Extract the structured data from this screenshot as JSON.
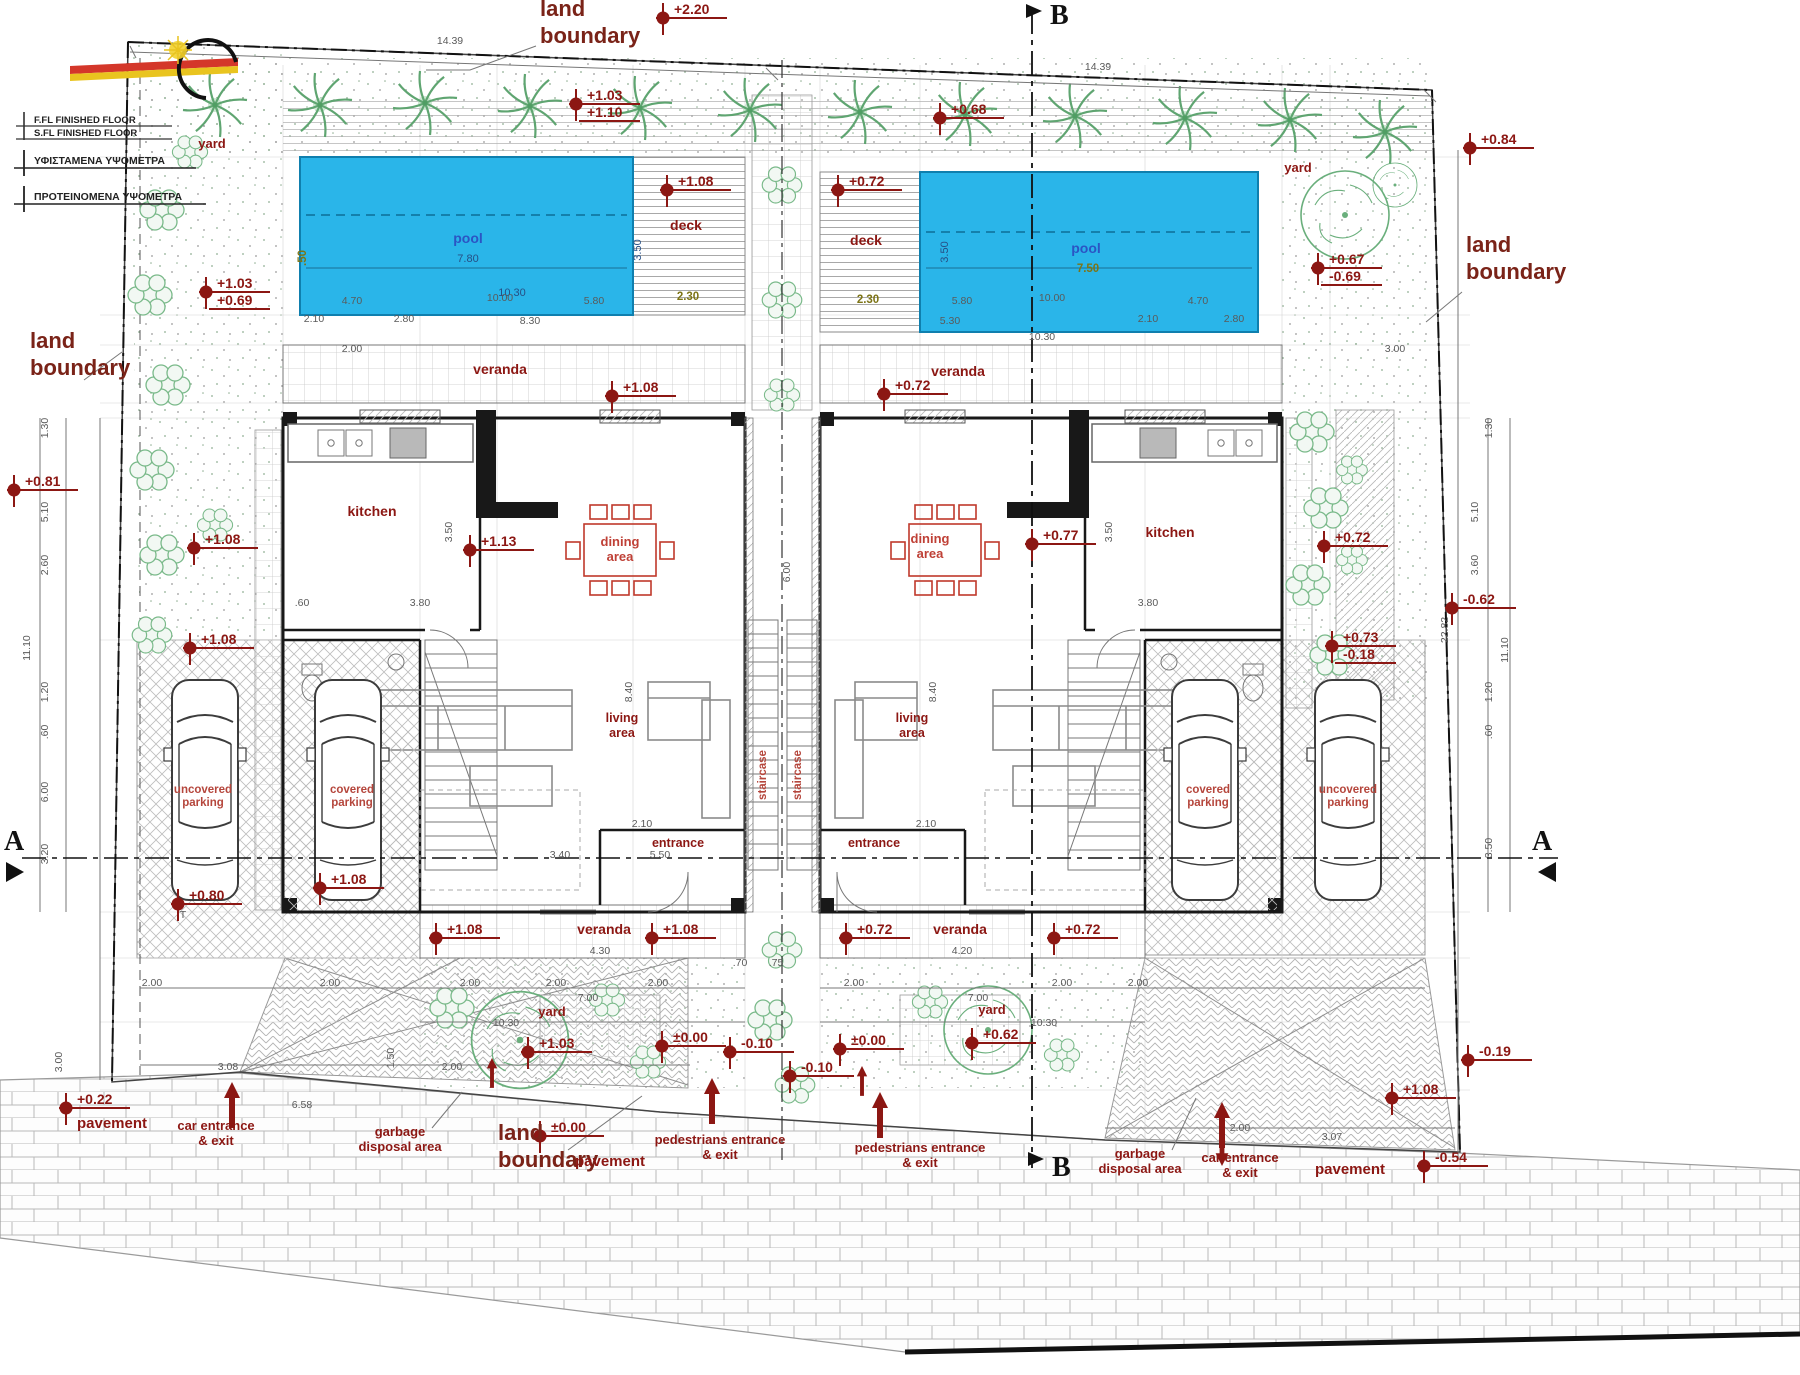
{
  "drawing": {
    "type": "architectural site plan, twin villas with pools",
    "colors": {
      "pool": "#2ab5e9",
      "pool_border": "#0f7fae",
      "label_dark_red": "#8c1713",
      "furniture_red": "#c0392b",
      "tree_green": "#5fa571",
      "wall_black": "#181818"
    }
  },
  "legend": {
    "row1a": "F.FL FINISHED FLOOR",
    "row1b": "S.FL FINISHED FLOOR",
    "row2": "ΥΦΙΣΤΑΜΕΝΑ ΥΨΟΜΕΤΡΑ",
    "row3": "ΠΡΟΤΕΙΝΟΜΕΝΑ ΥΨΟΜΕΤΡΑ"
  },
  "sections": {
    "a": "A",
    "b": "B"
  },
  "labels": [
    {
      "n": "label-yard-top-left",
      "t": "yard",
      "x": 212,
      "y": 148,
      "c": "lab-place-sm"
    },
    {
      "n": "label-yard-top-right",
      "t": "yard",
      "x": 1298,
      "y": 172,
      "c": "lab-place-sm"
    },
    {
      "n": "label-yard-bottom-left",
      "t": "yard",
      "x": 552,
      "y": 1016,
      "c": "lab-place-sm"
    },
    {
      "n": "label-yard-bottom-right",
      "t": "yard",
      "x": 992,
      "y": 1014,
      "c": "lab-place-sm"
    },
    {
      "n": "label-pool-left",
      "t": "pool",
      "x": 468,
      "y": 243,
      "c": "lab-pool"
    },
    {
      "n": "label-pool-right",
      "t": "pool",
      "x": 1086,
      "y": 253,
      "c": "lab-pool"
    },
    {
      "n": "label-deck-left",
      "t": "deck",
      "x": 686,
      "y": 230,
      "c": "lab-room"
    },
    {
      "n": "label-deck-right",
      "t": "deck",
      "x": 866,
      "y": 245,
      "c": "lab-room"
    },
    {
      "n": "label-veranda-top-left",
      "t": "veranda",
      "x": 500,
      "y": 374,
      "c": "lab-room"
    },
    {
      "n": "label-veranda-top-right",
      "t": "veranda",
      "x": 958,
      "y": 376,
      "c": "lab-room"
    },
    {
      "n": "label-kitchen-left",
      "t": "kitchen",
      "x": 372,
      "y": 516,
      "c": "lab-room"
    },
    {
      "n": "label-kitchen-right",
      "t": "kitchen",
      "x": 1170,
      "y": 537,
      "c": "lab-room"
    },
    {
      "n": "label-dining-left",
      "ls": [
        "dining",
        "area"
      ],
      "x": 620,
      "y": 546,
      "c": "lab-red",
      "lh": 15
    },
    {
      "n": "label-dining-right",
      "ls": [
        "dining",
        "area"
      ],
      "x": 930,
      "y": 543,
      "c": "lab-red",
      "lh": 15
    },
    {
      "n": "label-living-left",
      "ls": [
        "living",
        "area"
      ],
      "x": 622,
      "y": 722,
      "c": "lab-room-sm",
      "lh": 15
    },
    {
      "n": "label-living-right",
      "ls": [
        "living",
        "area"
      ],
      "x": 912,
      "y": 722,
      "c": "lab-room-sm",
      "lh": 15
    },
    {
      "n": "label-entrance-left",
      "t": "entrance",
      "x": 678,
      "y": 847,
      "c": "lab-room-sm"
    },
    {
      "n": "label-entrance-right",
      "t": "entrance",
      "x": 874,
      "y": 847,
      "c": "lab-room-sm"
    },
    {
      "n": "label-staircase-left",
      "t": "staircase",
      "x": 766,
      "y": 775,
      "c": "lab-red-sm",
      "r": -90
    },
    {
      "n": "label-staircase-right",
      "t": "staircase",
      "x": 801,
      "y": 775,
      "c": "lab-red-sm",
      "r": -90
    },
    {
      "n": "label-covered-parking-left",
      "ls": [
        "covered",
        "parking"
      ],
      "x": 352,
      "y": 793,
      "c": "lab-red-sm",
      "lh": 13
    },
    {
      "n": "label-uncovered-parking-left",
      "ls": [
        "uncovered",
        "parking"
      ],
      "x": 203,
      "y": 793,
      "c": "lab-red-sm",
      "lh": 13
    },
    {
      "n": "label-covered-parking-right",
      "ls": [
        "covered",
        "parking"
      ],
      "x": 1208,
      "y": 793,
      "c": "lab-red-sm",
      "lh": 13
    },
    {
      "n": "label-uncovered-parking-right",
      "ls": [
        "uncovered",
        "parking"
      ],
      "x": 1348,
      "y": 793,
      "c": "lab-red-sm",
      "lh": 13
    },
    {
      "n": "label-veranda-bottom-left",
      "t": "veranda",
      "x": 604,
      "y": 934,
      "c": "lab-room"
    },
    {
      "n": "label-veranda-bottom-right",
      "t": "veranda",
      "x": 960,
      "y": 934,
      "c": "lab-room"
    },
    {
      "n": "label-land-boundary-top",
      "ls": [
        "land",
        "boundary"
      ],
      "x": 540,
      "y": 16,
      "c": "lab-boundary",
      "a": "start",
      "lh": 27
    },
    {
      "n": "label-land-boundary-left",
      "ls": [
        "land",
        "boundary"
      ],
      "x": 30,
      "y": 348,
      "c": "lab-boundary",
      "a": "start",
      "lh": 27
    },
    {
      "n": "label-land-boundary-right",
      "ls": [
        "land",
        "boundary"
      ],
      "x": 1466,
      "y": 252,
      "c": "lab-boundary",
      "a": "start",
      "lh": 27
    },
    {
      "n": "label-land-boundary-bottom",
      "ls": [
        "land",
        "boundary"
      ],
      "x": 498,
      "y": 1140,
      "c": "lab-boundary",
      "a": "start",
      "lh": 27
    },
    {
      "n": "label-pavement-bottom-left",
      "t": "pavement",
      "x": 112,
      "y": 1128,
      "c": "lab-place"
    },
    {
      "n": "label-car-entrance-bottom-left",
      "ls": [
        "car entrance",
        "& exit"
      ],
      "x": 216,
      "y": 1130,
      "c": "lab-place-sm",
      "lh": 15
    },
    {
      "n": "label-garbage-bottom-left",
      "ls": [
        "garbage",
        "disposal area"
      ],
      "x": 400,
      "y": 1136,
      "c": "lab-place-sm",
      "lh": 15
    },
    {
      "n": "label-pavement-bottom-center",
      "t": "pavement",
      "x": 610,
      "y": 1166,
      "c": "lab-place"
    },
    {
      "n": "label-pedestrians-left",
      "ls": [
        "pedestrians entrance",
        "& exit"
      ],
      "x": 720,
      "y": 1144,
      "c": "lab-place-sm",
      "lh": 15
    },
    {
      "n": "label-pedestrians-right",
      "ls": [
        "pedestrians entrance",
        "& exit"
      ],
      "x": 920,
      "y": 1152,
      "c": "lab-place-sm",
      "lh": 15
    },
    {
      "n": "label-garbage-bottom-right",
      "ls": [
        "garbage",
        "disposal area"
      ],
      "x": 1140,
      "y": 1158,
      "c": "lab-place-sm",
      "lh": 15
    },
    {
      "n": "label-car-entrance-bottom-right",
      "ls": [
        "car entrance",
        "& exit"
      ],
      "x": 1240,
      "y": 1162,
      "c": "lab-place-sm",
      "lh": 15
    },
    {
      "n": "label-pavement-bottom-right",
      "t": "pavement",
      "x": 1350,
      "y": 1174,
      "c": "lab-place"
    },
    {
      "n": "label-t-mark",
      "t": "T",
      "x": 183,
      "y": 918,
      "c": "dim"
    }
  ],
  "elevation_markers": [
    {
      "v": "+2.20",
      "x": 663,
      "y": 18
    },
    {
      "v": "+1.03",
      "v2": "+1.10",
      "x": 576,
      "y": 104
    },
    {
      "v": "+0.68",
      "x": 940,
      "y": 118
    },
    {
      "v": "+1.08",
      "x": 667,
      "y": 190
    },
    {
      "v": "+0.72",
      "x": 838,
      "y": 190
    },
    {
      "v": "+1.03",
      "v2": "+0.69",
      "x": 206,
      "y": 292
    },
    {
      "v": "+0.67",
      "v2": "-0.69",
      "x": 1318,
      "y": 268
    },
    {
      "v": "+0.84",
      "x": 1470,
      "y": 148
    },
    {
      "v": "+1.08",
      "x": 612,
      "y": 396
    },
    {
      "v": "+0.72",
      "x": 884,
      "y": 394
    },
    {
      "v": "+0.81",
      "x": 14,
      "y": 490
    },
    {
      "v": "+1.08",
      "x": 194,
      "y": 548
    },
    {
      "v": "+1.13",
      "x": 470,
      "y": 550
    },
    {
      "v": "+0.77",
      "x": 1032,
      "y": 544
    },
    {
      "v": "+0.72",
      "x": 1324,
      "y": 546
    },
    {
      "v": "-0.62",
      "x": 1452,
      "y": 608
    },
    {
      "v": "+1.08",
      "x": 190,
      "y": 648
    },
    {
      "v": "+0.73",
      "v2": "-0.18",
      "x": 1332,
      "y": 646
    },
    {
      "v": "+0.80",
      "x": 178,
      "y": 904
    },
    {
      "v": "+1.08",
      "x": 320,
      "y": 888
    },
    {
      "v": "+1.08",
      "x": 436,
      "y": 938
    },
    {
      "v": "+1.08",
      "x": 652,
      "y": 938
    },
    {
      "v": "+0.72",
      "x": 846,
      "y": 938
    },
    {
      "v": "+0.72",
      "x": 1054,
      "y": 938
    },
    {
      "v": "+1.03",
      "x": 528,
      "y": 1052
    },
    {
      "v": "±0.00",
      "x": 662,
      "y": 1046
    },
    {
      "v": "-0.10",
      "x": 730,
      "y": 1052
    },
    {
      "v": "±0.00",
      "x": 840,
      "y": 1049
    },
    {
      "v": "-0.10",
      "x": 790,
      "y": 1076
    },
    {
      "v": "+0.62",
      "x": 972,
      "y": 1043
    },
    {
      "v": "+1.08",
      "x": 1392,
      "y": 1098
    },
    {
      "v": "+0.22",
      "x": 66,
      "y": 1108
    },
    {
      "v": "±0.00",
      "x": 540,
      "y": 1136
    },
    {
      "v": "-0.19",
      "x": 1468,
      "y": 1060
    },
    {
      "v": "-0.54",
      "x": 1424,
      "y": 1166
    }
  ],
  "dimensions": [
    {
      "t": "14.39",
      "x": 450,
      "y": 44
    },
    {
      "t": "14.39",
      "x": 1098,
      "y": 70
    },
    {
      "t": "7.80",
      "x": 468,
      "y": 262,
      "c": "dimb"
    },
    {
      "t": "10.30",
      "x": 512,
      "y": 296,
      "c": "dimb"
    },
    {
      "t": "3.50",
      "x": 641,
      "y": 250,
      "r": -90,
      "c": "dimb"
    },
    {
      "t": ".50",
      "x": 306,
      "y": 258,
      "r": -90,
      "c": "dimo"
    },
    {
      "t": "4.70",
      "x": 352,
      "y": 304
    },
    {
      "t": "10.00",
      "x": 500,
      "y": 301
    },
    {
      "t": "5.80",
      "x": 594,
      "y": 304
    },
    {
      "t": "2.10",
      "x": 314,
      "y": 322
    },
    {
      "t": "2.80",
      "x": 404,
      "y": 322
    },
    {
      "t": "8.30",
      "x": 530,
      "y": 324
    },
    {
      "t": "2.30",
      "x": 688,
      "y": 300,
      "c": "dimo"
    },
    {
      "t": "2.30",
      "x": 868,
      "y": 303,
      "c": "dimo"
    },
    {
      "t": "7.50",
      "x": 1088,
      "y": 272,
      "c": "dimo"
    },
    {
      "t": "3.50",
      "x": 948,
      "y": 252,
      "r": -90,
      "c": "dimb"
    },
    {
      "t": "5.80",
      "x": 962,
      "y": 304
    },
    {
      "t": "10.00",
      "x": 1052,
      "y": 301
    },
    {
      "t": "4.70",
      "x": 1198,
      "y": 304
    },
    {
      "t": "5.30",
      "x": 950,
      "y": 324
    },
    {
      "t": "2.10",
      "x": 1148,
      "y": 322
    },
    {
      "t": "2.80",
      "x": 1234,
      "y": 322
    },
    {
      "t": "10.30",
      "x": 1042,
      "y": 340
    },
    {
      "t": "1.30",
      "x": 48,
      "y": 428,
      "r": -90
    },
    {
      "t": "5.10",
      "x": 48,
      "y": 512,
      "r": -90
    },
    {
      "t": "2.60",
      "x": 48,
      "y": 565,
      "r": -90
    },
    {
      "t": "11.10",
      "x": 30,
      "y": 648,
      "r": -90
    },
    {
      "t": "1.20",
      "x": 48,
      "y": 692,
      "r": -90
    },
    {
      "t": ".60",
      "x": 48,
      "y": 732,
      "r": -90
    },
    {
      "t": "6.00",
      "x": 48,
      "y": 792,
      "r": -90
    },
    {
      "t": "3.20",
      "x": 48,
      "y": 854,
      "r": -90
    },
    {
      "t": "1.30",
      "x": 1492,
      "y": 428,
      "r": -90
    },
    {
      "t": "5.10",
      "x": 1478,
      "y": 512,
      "r": -90
    },
    {
      "t": "3.60",
      "x": 1478,
      "y": 565,
      "r": -90
    },
    {
      "t": "22.82",
      "x": 1448,
      "y": 630,
      "r": -90
    },
    {
      "t": "11.10",
      "x": 1508,
      "y": 650,
      "r": -90
    },
    {
      "t": "1.20",
      "x": 1492,
      "y": 692,
      "r": -90
    },
    {
      "t": ".60",
      "x": 1492,
      "y": 732,
      "r": -90
    },
    {
      "t": "3.50",
      "x": 1492,
      "y": 848,
      "r": -90
    },
    {
      "t": ".60",
      "x": 302,
      "y": 606
    },
    {
      "t": "3.80",
      "x": 420,
      "y": 606
    },
    {
      "t": "3.50",
      "x": 452,
      "y": 532,
      "r": -90
    },
    {
      "t": "3.80",
      "x": 1148,
      "y": 606
    },
    {
      "t": "3.50",
      "x": 1112,
      "y": 532,
      "r": -90
    },
    {
      "t": "6.00",
      "x": 790,
      "y": 572,
      "r": -90
    },
    {
      "t": "8.40",
      "x": 632,
      "y": 692,
      "r": -90
    },
    {
      "t": "8.40",
      "x": 936,
      "y": 692,
      "r": -90
    },
    {
      "t": "5.50",
      "x": 660,
      "y": 858
    },
    {
      "t": "3.40",
      "x": 560,
      "y": 858
    },
    {
      "t": "2.10",
      "x": 642,
      "y": 827
    },
    {
      "t": "2.10",
      "x": 926,
      "y": 827
    },
    {
      "t": "4.30",
      "x": 600,
      "y": 954
    },
    {
      "t": "4.20",
      "x": 962,
      "y": 954
    },
    {
      "t": ".70",
      "x": 740,
      "y": 966
    },
    {
      "t": ".75",
      "x": 776,
      "y": 966
    },
    {
      "t": "2.00",
      "x": 152,
      "y": 986
    },
    {
      "t": "2.00",
      "x": 330,
      "y": 986
    },
    {
      "t": "2.00",
      "x": 470,
      "y": 986
    },
    {
      "t": "2.00",
      "x": 556,
      "y": 986
    },
    {
      "t": "2.00",
      "x": 658,
      "y": 986
    },
    {
      "t": "7.00",
      "x": 588,
      "y": 1001
    },
    {
      "t": "10.30",
      "x": 506,
      "y": 1026
    },
    {
      "t": "2.00",
      "x": 854,
      "y": 986
    },
    {
      "t": "2.00",
      "x": 1062,
      "y": 986
    },
    {
      "t": "2.00",
      "x": 1138,
      "y": 986
    },
    {
      "t": "7.00",
      "x": 978,
      "y": 1001
    },
    {
      "t": "10.30",
      "x": 1044,
      "y": 1026
    },
    {
      "t": "3.08",
      "x": 228,
      "y": 1070
    },
    {
      "t": "2.00",
      "x": 452,
      "y": 1070
    },
    {
      "t": "1.50",
      "x": 394,
      "y": 1058,
      "r": -90
    },
    {
      "t": "6.58",
      "x": 302,
      "y": 1108
    },
    {
      "t": "3.00",
      "x": 62,
      "y": 1062,
      "r": -90
    },
    {
      "t": "2.00",
      "x": 1240,
      "y": 1131
    },
    {
      "t": "3.07",
      "x": 1332,
      "y": 1140
    },
    {
      "t": "3.00",
      "x": 1395,
      "y": 352
    },
    {
      "t": "2.00",
      "x": 352,
      "y": 352
    }
  ]
}
